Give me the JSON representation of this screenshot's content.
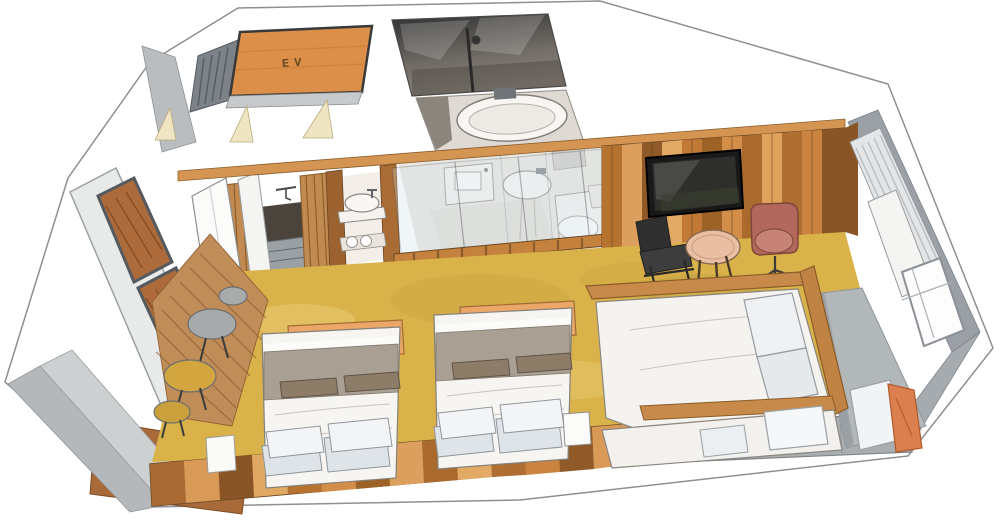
{
  "meta": {
    "title": "Hand-drawn isometric cutaway floor plan of a hotel guest room",
    "style": "colored-pencil watercolor axonometric illustration on white background"
  },
  "labels": {
    "elevator": "EV"
  },
  "palette": {
    "paper": "#ffffff",
    "cut_wall_gray": "#b7bbbd",
    "cut_wall_dark": "#9aa0a5",
    "elevator_floor_orange": "#dc8f49",
    "shower_dark": "#3a3a3a",
    "tub_white": "#f7f6f3",
    "carpet_mustard": "#d9b24a",
    "wood_plank_mid": "#c8863f",
    "wood_plank_dark": "#8f5a28",
    "wood_plank_light": "#e3aa66",
    "entry_slat_wood": "#c08c58",
    "deck_brown": "#a96a3a",
    "tv_black": "#191919",
    "lounge_chair_black": "#303030",
    "round_table_tan": "#e9bfa4",
    "armchair_rust": "#b2685c",
    "headboard_orange": "#eaa768",
    "duvet_white": "#f6f5f1",
    "blanket_gray": "#a9a093",
    "pillow_gray": "#dfe4e9",
    "bolster_brown": "#8d7c68",
    "sofa_wood": "#c88a4a",
    "bench_gray": "#b2b7ba",
    "orange_pillow": "#dc7f4e",
    "curtain_gray": "#e3e5e7",
    "glass_tint": "#cfdfe8",
    "door_swing_beige": "#efe5c2"
  },
  "rooms": [
    {
      "name": "elevator-hall",
      "label": "EV",
      "floor": "orange wood"
    },
    {
      "name": "shower-room",
      "features": [
        "shower rail",
        "dark tiled walls"
      ]
    },
    {
      "name": "bath-room",
      "features": [
        "bathtub",
        "wall faucet"
      ]
    },
    {
      "name": "washroom",
      "features": [
        "square sink",
        "oval basin",
        "toilet",
        "glass partition walls"
      ]
    },
    {
      "name": "entry-closet",
      "features": [
        "open white doors",
        "slatted screens",
        "minibar nook",
        "round basin vanity",
        "towel shelf"
      ]
    },
    {
      "name": "bedroom",
      "floor": "mustard carpet",
      "features": [
        "two double beds",
        "wood plank TV wall"
      ]
    },
    {
      "name": "window-lounge",
      "features": [
        "daybed sofa",
        "gray window platform",
        "curtain",
        "corner windows"
      ]
    },
    {
      "name": "balcony",
      "features": [
        "wood deck",
        "left window wall",
        "round side tables"
      ]
    }
  ],
  "furniture": [
    {
      "name": "bed-1",
      "parts": [
        "orange headboard block",
        "gray folded blanket",
        "white duvet",
        "two brown bolsters",
        "four gray-white pillows"
      ]
    },
    {
      "name": "bed-2",
      "parts": [
        "orange headboard block",
        "gray folded blanket",
        "white duvet",
        "two brown bolsters",
        "four gray-white pillows"
      ]
    },
    {
      "name": "wall-tv",
      "color": "#191919"
    },
    {
      "name": "lounge-chair",
      "color": "#303030"
    },
    {
      "name": "round-coffee-table",
      "color": "#e9bfa4"
    },
    {
      "name": "swivel-armchair",
      "color": "#b2685c"
    },
    {
      "name": "daybed-sofa",
      "parts": [
        "wood frame",
        "white mattress",
        "white cushions"
      ]
    },
    {
      "name": "window-bench-pillows",
      "colors": [
        "#f2f3f4",
        "#dc7f4e"
      ]
    },
    {
      "name": "side-stools",
      "colors": [
        "#a8abab",
        "#d2a53f"
      ]
    },
    {
      "name": "nightstand-box",
      "color": "#fbfbfa"
    }
  ]
}
